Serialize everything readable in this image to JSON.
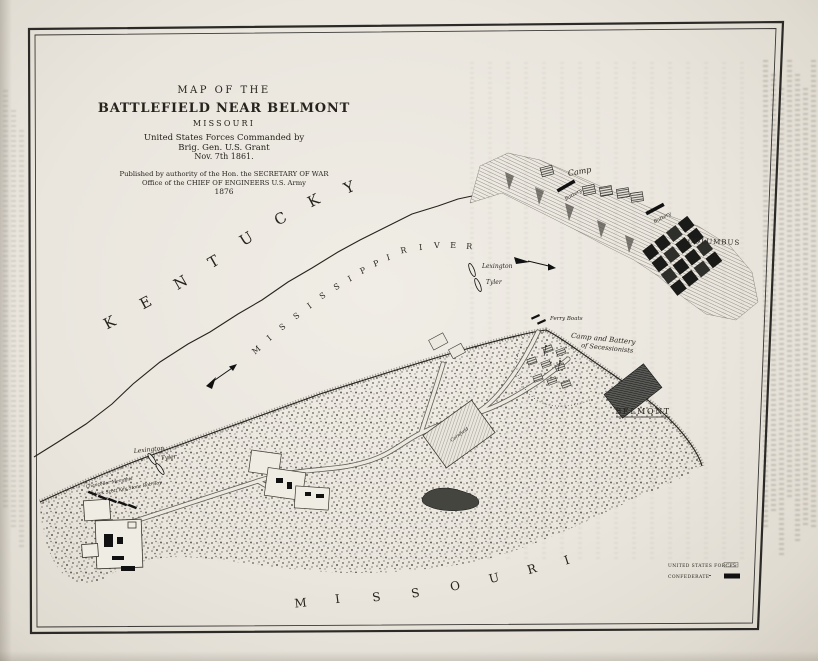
{
  "photo": {
    "paper_color": "#eae6de",
    "ink_color": "#26231d"
  },
  "map": {
    "title_block": {
      "line1": "MAP OF THE",
      "line2": "BATTLEFIELD NEAR BELMONT",
      "line3": "MISSOURI",
      "line4": "United States Forces Commanded by",
      "line5": "Brig. Gen. U.S. Grant",
      "line6": "Nov. 7th 1861.",
      "pub1": "Published by authority of the Hon. the SECRETARY OF WAR",
      "pub2": "Office of the CHIEF OF ENGINEERS U.S. Army",
      "pub3": "1876"
    },
    "regions": {
      "kentucky": "KENTUCKY",
      "missouri": "MISSOURI",
      "river": "MISSISSIPPI RIVER"
    },
    "places": {
      "columbus": "COLUMBUS",
      "belmont": "BELMONT",
      "camp": "Camp",
      "battery": "Battery",
      "ferry_boats": "Ferry Boats",
      "secession_camp_1": "Camp and Battery",
      "secession_camp_2": "of Secessionists",
      "gunboat_lexington": "Lexington",
      "gunboat_tyler": "Tyler",
      "transports_1": "Chancellor  Memphis",
      "transports_2": "Aleck Scott  Key Stone  Rob Roy",
      "cornfield": "Cornfield"
    },
    "legend": {
      "us_label": "UNITED STATES FORCES",
      "confederate_label": "CONFEDERATE",
      "us_symbol": "hatched-bar",
      "confederate_symbol": "solid-black-bar"
    }
  }
}
